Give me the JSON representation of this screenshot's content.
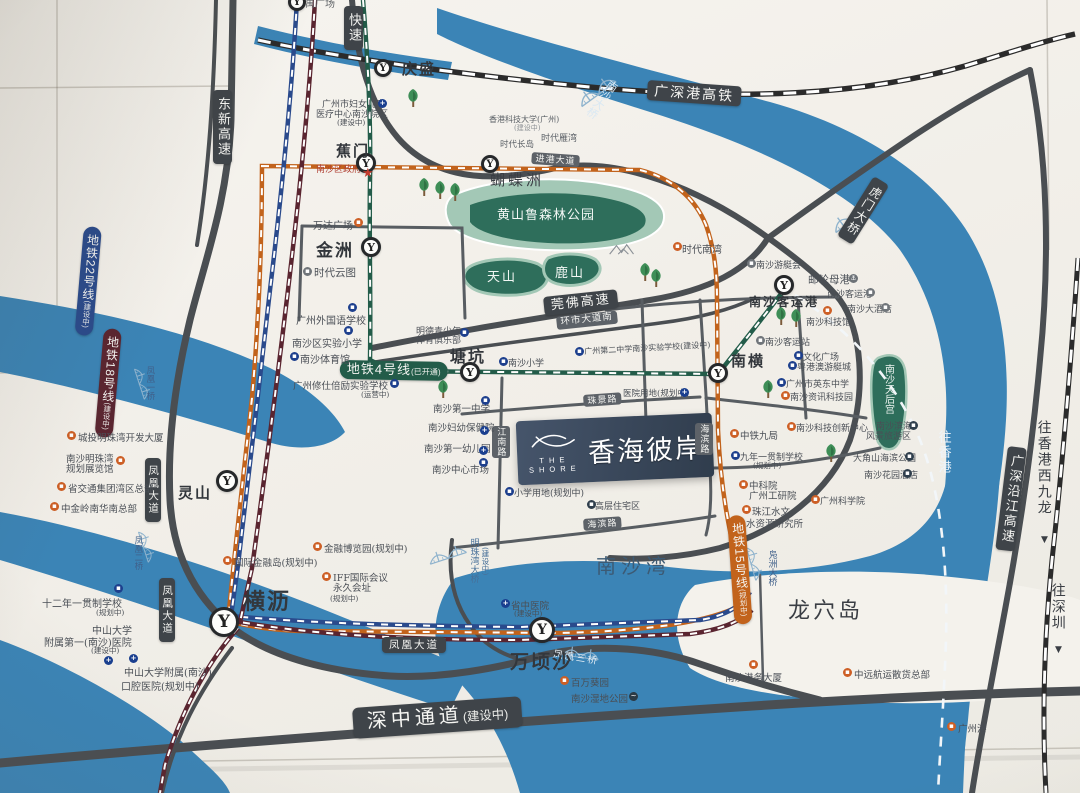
{
  "palette": {
    "water": "#3b84b6",
    "park_dark": "#2e6e5b",
    "park_light": "#a3c8b6",
    "road": "#4a4e52",
    "road2": "#585d62",
    "rail": "#2b2b2b",
    "m4": "#235c49",
    "m15": "#c2631c",
    "m22": "#2a4a8c",
    "m18": "#5a2530",
    "badge": "#3f4449",
    "plaque": "#39475a"
  },
  "plaque": {
    "the": "THE",
    "shore": "SHORE",
    "name": "香海彼岸"
  },
  "stations": [
    {
      "x": 297,
      "y": 2,
      "r": 9
    },
    {
      "t": "庆盛",
      "x": 383,
      "y": 68,
      "r": 9,
      "lx": 402,
      "ly": 58,
      "lfs": 15
    },
    {
      "t": "蕉门",
      "x": 366,
      "y": 163,
      "r": 10,
      "lx": 336,
      "ly": 140,
      "lfs": 15
    },
    {
      "t": "金洲",
      "x": 371,
      "y": 247,
      "r": 10,
      "lx": 316,
      "ly": 236,
      "lfs": 17
    },
    {
      "x": 490,
      "y": 164,
      "r": 9
    },
    {
      "t": "塘坑",
      "x": 470,
      "y": 372,
      "r": 10,
      "lx": 450,
      "ly": 343,
      "lfs": 16
    },
    {
      "t": "南横",
      "x": 718,
      "y": 373,
      "r": 10,
      "lx": 731,
      "ly": 350,
      "lfs": 15
    },
    {
      "t": "南沙客运港",
      "x": 784,
      "y": 285,
      "r": 10,
      "lx": 749,
      "ly": 293,
      "lfs": 12
    },
    {
      "t": "灵山",
      "x": 227,
      "y": 481,
      "r": 11,
      "lx": 178,
      "ly": 482,
      "lfs": 15
    },
    {
      "t": "横沥",
      "x": 224,
      "y": 622,
      "r": 15,
      "lx": 243,
      "ly": 584,
      "lfs": 22
    },
    {
      "t": "万顷沙",
      "x": 542,
      "y": 630,
      "r": 13,
      "lx": 510,
      "ly": 647,
      "lfs": 19
    }
  ],
  "badges": [
    {
      "t": "东新高速",
      "x": 213,
      "y": 90,
      "v": 1,
      "fs": 13
    },
    {
      "t": "快速",
      "x": 344,
      "y": 6,
      "v": 1,
      "fs": 13
    },
    {
      "t": "广深港高铁",
      "x": 648,
      "y": 80,
      "fs": 14,
      "rot": 4
    },
    {
      "t": "进港大道",
      "x": 532,
      "y": 152,
      "fs": 9,
      "rot": 4,
      "cls": "sm"
    },
    {
      "t": "莞佛高速",
      "x": 543,
      "y": 297,
      "fs": 13,
      "rot": -6
    },
    {
      "t": "环市大道南",
      "x": 556,
      "y": 317,
      "fs": 9.5,
      "rot": -6,
      "cls": "sm"
    },
    {
      "t": "地铁4号线",
      "sub": "(已开通)",
      "x": 340,
      "y": 360,
      "fs": 13,
      "bg": "m4",
      "cls": "pill",
      "rot": 1
    },
    {
      "t": "地铁22号线",
      "sub": "(建设中)",
      "x": 84,
      "y": 226,
      "v": 1,
      "fs": 12,
      "bg": "m22",
      "cls": "pill",
      "rot": 5
    },
    {
      "t": "地铁18号线",
      "sub": "(建设中)",
      "x": 104,
      "y": 328,
      "v": 1,
      "fs": 12,
      "bg": "m18",
      "cls": "pill",
      "rot": 5
    },
    {
      "t": "地铁15号线",
      "sub": "(规划中)",
      "x": 727,
      "y": 516,
      "v": 1,
      "fs": 12,
      "bg": "m15",
      "cls": "pill",
      "rot": -4
    },
    {
      "t": "凤凰大道",
      "x": 145,
      "y": 458,
      "v": 1,
      "fs": 10.5
    },
    {
      "t": "凤凰大道",
      "x": 159,
      "y": 578,
      "v": 1,
      "fs": 10.5
    },
    {
      "t": "凤凰大道",
      "x": 382,
      "y": 637,
      "fs": 10.5
    },
    {
      "t": "深中通道",
      "sub": "(建设中)",
      "x": 352,
      "y": 708,
      "fs": 20,
      "rot": -4,
      "cls": "big"
    },
    {
      "t": "虎门大桥",
      "x": 874,
      "y": 176,
      "v": 1,
      "fs": 12,
      "rot": 32
    },
    {
      "t": "广深沿江高速",
      "x": 1008,
      "y": 446,
      "v": 1,
      "fs": 13,
      "rot": 7
    },
    {
      "t": "海滨路",
      "x": 695,
      "y": 423,
      "v": 1,
      "fs": 9,
      "cls": "sm"
    },
    {
      "t": "海滨路",
      "x": 583,
      "y": 519,
      "fs": 9,
      "cls": "sm",
      "rot": -4
    },
    {
      "t": "珠景路",
      "x": 583,
      "y": 395,
      "fs": 9,
      "cls": "sm",
      "rot": -4
    },
    {
      "t": "江南路",
      "x": 492,
      "y": 426,
      "v": 1,
      "fs": 9,
      "cls": "sm"
    }
  ],
  "labels": [
    {
      "t": "番禺广场",
      "x": 295,
      "y": 0,
      "fs": 10,
      "c": "#606468"
    },
    {
      "t": "蝴蝶洲",
      "x": 490,
      "y": 173,
      "fs": 15,
      "ls": 3
    },
    {
      "t": "黄山鲁森林公园",
      "x": 497,
      "y": 209,
      "fs": 13,
      "c": "#f2f7f4",
      "ls": 1
    },
    {
      "t": "天山",
      "x": 487,
      "y": 271,
      "fs": 13,
      "c": "#f2f7f4",
      "ls": 2
    },
    {
      "t": "鹿山",
      "x": 555,
      "y": 267,
      "fs": 13,
      "c": "#f2f7f4",
      "ls": 2
    },
    {
      "t": "南沙大桥",
      "x": 610,
      "y": 78,
      "fs": 11,
      "c": "#d9e8f3",
      "v": 1,
      "rot": 36
    },
    {
      "t": "香港科技大学(广州)",
      "x": 489,
      "y": 116,
      "fs": 8,
      "c": "#5c6167"
    },
    {
      "t": "(建设中)",
      "x": 514,
      "y": 125,
      "fs": 7,
      "c": "#8a8e93"
    },
    {
      "t": "时代长岛",
      "x": 500,
      "y": 141,
      "fs": 8.5,
      "c": "#5c6167"
    },
    {
      "t": "时代雁湾",
      "x": 541,
      "y": 135,
      "fs": 9,
      "c": "#5c6167"
    },
    {
      "t": "南沙区政府",
      "x": 316,
      "y": 166,
      "fs": 9,
      "c": "#b04034"
    },
    {
      "t": "南沙湾",
      "x": 596,
      "y": 556,
      "fs": 20,
      "c": "#3c5a74",
      "ls": 5
    },
    {
      "t": "龙穴岛",
      "x": 788,
      "y": 600,
      "fs": 22,
      "ls": 3
    },
    {
      "t": "明珠湾大桥",
      "x": 468,
      "y": 538,
      "fs": 9,
      "c": "#477099",
      "v": 1
    },
    {
      "t": "(建设中)",
      "x": 481,
      "y": 547,
      "fs": 7.5,
      "c": "#477099",
      "v": 1
    },
    {
      "t": "凤凰一桥",
      "x": 145,
      "y": 366,
      "fs": 8.5,
      "c": "#40608a",
      "v": 1
    },
    {
      "t": "凤凰二桥",
      "x": 133,
      "y": 536,
      "fs": 8.5,
      "c": "#40608a",
      "v": 1
    },
    {
      "t": "凤凰三桥",
      "x": 554,
      "y": 650,
      "fs": 9.5,
      "c": "#eaf1f7",
      "rot": 9,
      "ls": 2
    },
    {
      "t": "凫洲大桥",
      "x": 766,
      "y": 550,
      "fs": 9,
      "c": "#40608a",
      "v": 1
    },
    {
      "t": "往香港",
      "x": 936,
      "y": 430,
      "fs": 13,
      "c": "#eef4f9",
      "v": 1,
      "ls": 2
    },
    {
      "t": "往香港西九龙",
      "x": 1036,
      "y": 420,
      "fs": 14,
      "c": "#3a3e44",
      "v": 1,
      "ls": 2
    },
    {
      "t": "▼",
      "x": 1041,
      "y": 536,
      "fs": 9,
      "c": "#3a3e44"
    },
    {
      "t": "往深圳",
      "x": 1050,
      "y": 583,
      "fs": 14,
      "c": "#3a3e44",
      "v": 1,
      "ls": 2
    },
    {
      "t": "▼",
      "x": 1055,
      "y": 646,
      "fs": 9,
      "c": "#3a3e44"
    },
    {
      "t": "南沙天后宫",
      "x": 882,
      "y": 364,
      "fs": 10,
      "c": "#ecf3ef",
      "v": 1
    }
  ],
  "pois": [
    {
      "t": "广州市妇女儿童",
      "x": 322,
      "y": 97,
      "fs": 9
    },
    {
      "t": "医疗中心南沙院区",
      "x": 316,
      "y": 107,
      "fs": 9,
      "i": "h",
      "ix": 378,
      "iy": 99
    },
    {
      "t": "(建设中)",
      "x": 337,
      "y": 117,
      "fs": 7.5
    },
    {
      "t": "万达广场",
      "x": 313,
      "y": 217,
      "fs": 10,
      "i": "o",
      "ix": 354,
      "iy": 218
    },
    {
      "t": "时代云图",
      "x": 314,
      "y": 265,
      "fs": 10.5,
      "i": "g",
      "ix": 303,
      "iy": 267
    },
    {
      "t": "广州外国语学校",
      "x": 296,
      "y": 312,
      "fs": 10,
      "i": "b",
      "ix": 348,
      "iy": 303
    },
    {
      "t": "南沙区实验小学",
      "x": 292,
      "y": 335,
      "fs": 10,
      "i": "b",
      "ix": 344,
      "iy": 326
    },
    {
      "t": "南沙体育馆",
      "x": 300,
      "y": 351,
      "fs": 10,
      "i": "b",
      "ix": 290,
      "iy": 352
    },
    {
      "t": "明德青少年",
      "x": 416,
      "y": 324,
      "fs": 9
    },
    {
      "t": "体育俱乐部",
      "x": 416,
      "y": 333,
      "fs": 9,
      "i": "b",
      "ix": 460,
      "iy": 328
    },
    {
      "t": "广州修仕倍励实验学校",
      "x": 293,
      "y": 378,
      "fs": 9.5,
      "i": "b",
      "ix": 390,
      "iy": 379
    },
    {
      "t": "(运营中)",
      "x": 361,
      "y": 389,
      "fs": 7.5
    },
    {
      "t": "南沙小学",
      "x": 508,
      "y": 356,
      "fs": 9,
      "i": "b",
      "ix": 499,
      "iy": 357
    },
    {
      "t": "广州第二中学南沙实验学校(建设中)",
      "x": 584,
      "y": 346,
      "fs": 8,
      "i": "b",
      "ix": 575,
      "iy": 347,
      "rot": -3
    },
    {
      "t": "医院用地(规划中)",
      "x": 623,
      "y": 387,
      "fs": 8.5,
      "i": "h",
      "ix": 680,
      "iy": 388
    },
    {
      "t": "南沙第一中学",
      "x": 433,
      "y": 401,
      "fs": 9.5,
      "i": "b",
      "ix": 481,
      "iy": 396
    },
    {
      "t": "南沙妇幼保健院",
      "x": 428,
      "y": 420,
      "fs": 9.5,
      "i": "h",
      "ix": 480,
      "iy": 426
    },
    {
      "t": "南沙第一幼儿园",
      "x": 424,
      "y": 441,
      "fs": 9.5,
      "i": "h",
      "ix": 479,
      "iy": 446
    },
    {
      "t": "南沙中心市场",
      "x": 432,
      "y": 462,
      "fs": 9.5,
      "i": "b",
      "ix": 479,
      "iy": 458
    },
    {
      "t": "小学用地(规划中)",
      "x": 514,
      "y": 486,
      "fs": 9,
      "i": "b",
      "ix": 505,
      "iy": 487
    },
    {
      "t": "高层住宅区",
      "x": 595,
      "y": 499,
      "fs": 9,
      "i": "d",
      "ix": 587,
      "iy": 500
    },
    {
      "t": "城投明珠湾开发大厦",
      "x": 78,
      "y": 430,
      "fs": 9.5,
      "i": "o",
      "ix": 67,
      "iy": 431
    },
    {
      "t": "南沙明珠湾",
      "x": 66,
      "y": 451,
      "fs": 9.5
    },
    {
      "t": "规划展览馆",
      "x": 66,
      "y": 461,
      "fs": 9.5,
      "i": "o",
      "ix": 116,
      "iy": 456
    },
    {
      "t": "省交通集团湾区总部",
      "x": 68,
      "y": 481,
      "fs": 9.5,
      "i": "o",
      "ix": 57,
      "iy": 482
    },
    {
      "t": "中金岭南华南总部",
      "x": 61,
      "y": 501,
      "fs": 9.5,
      "i": "o",
      "ix": 50,
      "iy": 502
    },
    {
      "t": "国际金融岛(规划中)",
      "x": 234,
      "y": 555,
      "fs": 9.5,
      "i": "o",
      "ix": 223,
      "iy": 556
    },
    {
      "t": "金融博览园(规划中)",
      "x": 324,
      "y": 541,
      "fs": 9.5,
      "i": "o",
      "ix": 313,
      "iy": 542
    },
    {
      "t": "IFF国际会议",
      "x": 333,
      "y": 570,
      "fs": 9.5,
      "i": "o",
      "ix": 322,
      "iy": 572
    },
    {
      "t": "永久会址",
      "x": 333,
      "y": 580,
      "fs": 9.5
    },
    {
      "t": "(规划中)",
      "x": 330,
      "y": 593,
      "fs": 7.5
    },
    {
      "t": "十二年一贯制学校",
      "x": 42,
      "y": 595,
      "fs": 10,
      "i": "b",
      "ix": 114,
      "iy": 584
    },
    {
      "t": "(规划中)",
      "x": 96,
      "y": 607,
      "fs": 7.5
    },
    {
      "t": "中山大学",
      "x": 92,
      "y": 622,
      "fs": 10
    },
    {
      "t": "附属第一(南沙)医院",
      "x": 44,
      "y": 634,
      "fs": 10
    },
    {
      "t": "(建设中)",
      "x": 91,
      "y": 645,
      "fs": 7.5
    },
    {
      "t": "中山大学附属(南沙)",
      "x": 124,
      "y": 664,
      "fs": 10,
      "i": "h",
      "ix": 104,
      "iy": 656
    },
    {
      "t": "口腔医院(规划中)",
      "x": 121,
      "y": 678,
      "fs": 10,
      "i": "h",
      "ix": 129,
      "iy": 654
    },
    {
      "t": "省中医院",
      "x": 511,
      "y": 598,
      "fs": 9.5,
      "i": "h",
      "ix": 501,
      "iy": 599
    },
    {
      "t": "(建设中)",
      "x": 514,
      "y": 608,
      "fs": 7.5
    },
    {
      "t": "百万葵园",
      "x": 571,
      "y": 675,
      "fs": 9.5,
      "i": "o",
      "ix": 560,
      "iy": 676
    },
    {
      "t": "南沙湿地公园",
      "x": 571,
      "y": 691,
      "fs": 9.5,
      "i": "w",
      "ix": 629,
      "iy": 692
    },
    {
      "t": "南沙港务大厦",
      "x": 725,
      "y": 670,
      "fs": 9.5,
      "i": "o",
      "ix": 749,
      "iy": 660
    },
    {
      "t": "中远航运散货总部",
      "x": 854,
      "y": 667,
      "fs": 9.5,
      "i": "o",
      "ix": 843,
      "iy": 668
    },
    {
      "t": "广州港",
      "x": 958,
      "y": 721,
      "fs": 9.5,
      "i": "o",
      "ix": 947,
      "iy": 722
    },
    {
      "t": "南沙游艇会",
      "x": 756,
      "y": 258,
      "fs": 9,
      "i": "g",
      "ix": 747,
      "iy": 259
    },
    {
      "t": "邮轮母港",
      "x": 808,
      "y": 272,
      "fs": 10.5,
      "i": "s",
      "ix": 849,
      "iy": 274
    },
    {
      "t": "南沙客运港",
      "x": 827,
      "y": 287,
      "fs": 9,
      "i": "g",
      "ix": 866,
      "iy": 288
    },
    {
      "t": "南沙大酒店",
      "x": 847,
      "y": 302,
      "fs": 9,
      "i": "g",
      "ix": 881,
      "iy": 303
    },
    {
      "t": "南沙科技馆",
      "x": 806,
      "y": 315,
      "fs": 9,
      "i": "o",
      "ix": 823,
      "iy": 306
    },
    {
      "t": "南沙客运站",
      "x": 765,
      "y": 335,
      "fs": 9,
      "i": "g",
      "ix": 756,
      "iy": 336
    },
    {
      "t": "文化广场",
      "x": 803,
      "y": 350,
      "fs": 9,
      "i": "b",
      "ix": 794,
      "iy": 351
    },
    {
      "t": "粤港澳游艇城",
      "x": 797,
      "y": 360,
      "fs": 9,
      "i": "b",
      "ix": 788,
      "iy": 361
    },
    {
      "t": "广州市英东中学",
      "x": 786,
      "y": 377,
      "fs": 9,
      "i": "b",
      "ix": 777,
      "iy": 378
    },
    {
      "t": "南沙资讯科技园",
      "x": 790,
      "y": 390,
      "fs": 9,
      "i": "o",
      "ix": 781,
      "iy": 391
    },
    {
      "t": "南沙科技创新中心",
      "x": 796,
      "y": 421,
      "fs": 9,
      "i": "o",
      "ix": 787,
      "iy": 422
    },
    {
      "t": "中铁九局",
      "x": 740,
      "y": 428,
      "fs": 9.5,
      "i": "o",
      "ix": 730,
      "iy": 429
    },
    {
      "t": "九年一贯制学校",
      "x": 740,
      "y": 450,
      "fs": 9,
      "i": "b",
      "ix": 731,
      "iy": 451
    },
    {
      "t": "(规划中)",
      "x": 753,
      "y": 460,
      "fs": 7.5
    },
    {
      "t": "中科院",
      "x": 749,
      "y": 478,
      "fs": 9.5,
      "i": "o",
      "ix": 739,
      "iy": 480
    },
    {
      "t": "广州工研院",
      "x": 749,
      "y": 488,
      "fs": 9.5
    },
    {
      "t": "珠江水文",
      "x": 752,
      "y": 504,
      "fs": 9.5,
      "i": "o",
      "ix": 742,
      "iy": 505
    },
    {
      "t": "水资源研究所",
      "x": 746,
      "y": 516,
      "fs": 9.5
    },
    {
      "t": "广州科学院",
      "x": 820,
      "y": 494,
      "fs": 9,
      "i": "o",
      "ix": 811,
      "iy": 495
    },
    {
      "t": "南沙滨海",
      "x": 876,
      "y": 419,
      "fs": 9,
      "i": "d",
      "ix": 909,
      "iy": 421
    },
    {
      "t": "风景旅游区",
      "x": 866,
      "y": 429,
      "fs": 9
    },
    {
      "t": "大角山海滨公园",
      "x": 853,
      "y": 451,
      "fs": 9,
      "i": "d",
      "ix": 905,
      "iy": 452
    },
    {
      "t": "南沙花园酒店",
      "x": 864,
      "y": 468,
      "fs": 9,
      "i": "d",
      "ix": 903,
      "iy": 469
    },
    {
      "t": "时代南湾",
      "x": 682,
      "y": 241,
      "fs": 10,
      "i": "o",
      "ix": 673,
      "iy": 242
    }
  ],
  "deco": {
    "trees": [
      [
        413,
        90
      ],
      [
        424,
        179
      ],
      [
        440,
        182
      ],
      [
        455,
        184
      ],
      [
        645,
        264
      ],
      [
        656,
        270
      ],
      [
        781,
        308
      ],
      [
        796,
        310
      ],
      [
        768,
        381
      ],
      [
        443,
        381
      ],
      [
        831,
        445
      ]
    ],
    "bridges": [
      [
        596,
        90,
        -36,
        1
      ],
      [
        850,
        216,
        -36,
        1
      ],
      [
        447,
        554,
        -18,
        0.9
      ],
      [
        143,
        383,
        72,
        0.75
      ],
      [
        147,
        546,
        72,
        0.75
      ],
      [
        581,
        653,
        8,
        0.85
      ],
      [
        755,
        563,
        74,
        0.8
      ]
    ],
    "mountain": [
      608,
      242
    ],
    "star": [
      362,
      166
    ]
  }
}
